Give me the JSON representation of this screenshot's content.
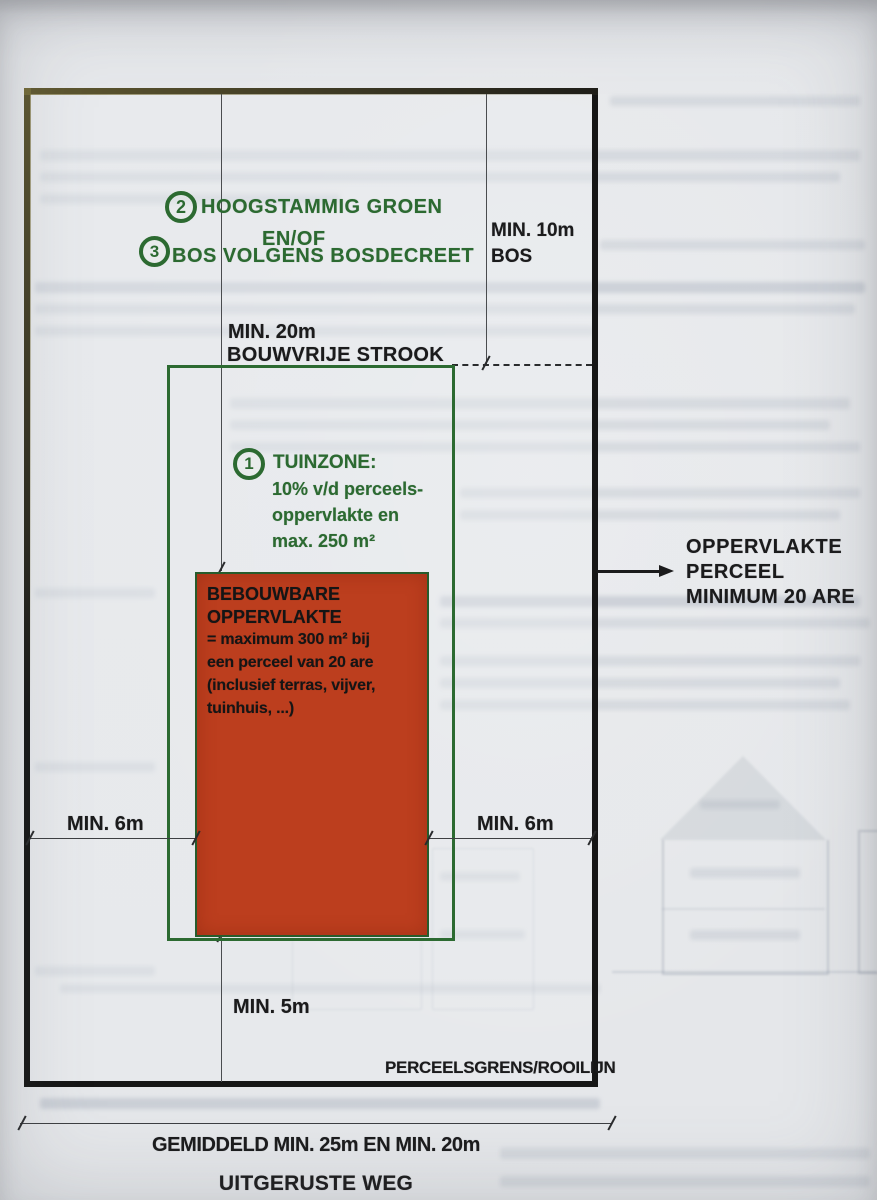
{
  "labels": {
    "zone23": {
      "badge2": "2",
      "line1": "HOOGSTAMMIG GROEN",
      "line2": "EN/OF",
      "badge3": "3",
      "line3": "BOS VOLGENS BOSDECREET"
    },
    "bos": {
      "line1": "MIN. 10m",
      "line2": "BOS"
    },
    "strook": {
      "line1": "MIN. 20m",
      "line2": "BOUWVRIJE STROOK"
    },
    "tuinzone": {
      "badge": "1",
      "title": "TUINZONE:",
      "line2": "10% v/d perceels-",
      "line3": "oppervlakte en",
      "line4": "max. 250 m²"
    },
    "bebouwbaar": {
      "line1": "BEBOUWBARE",
      "line2": "OPPERVLAKTE",
      "line3": "= maximum 300 m² bij",
      "line4": "een perceel van 20 are",
      "line5": "(inclusief terras, vijver,",
      "line6": "tuinhuis, ...)"
    },
    "perceel": {
      "line1": "OPPERVLAKTE",
      "line2": "PERCEEL",
      "line3": "MINIMUM 20 ARE"
    },
    "min6_left": "MIN. 6m",
    "min6_right": "MIN. 6m",
    "min5": "MIN. 5m",
    "perceelsgrens": "PERCEELSGRENS/ROOILIJN",
    "weg": {
      "line1": "GEMIDDELD MIN. 25m EN MIN. 20m",
      "line2": "UITGERUSTE WEG"
    }
  },
  "colors": {
    "zone_green": "#2c6a31",
    "buildable_red": "#bc3e1e",
    "line_black": "#1b1b1c",
    "paper": "#e5e7ea"
  }
}
